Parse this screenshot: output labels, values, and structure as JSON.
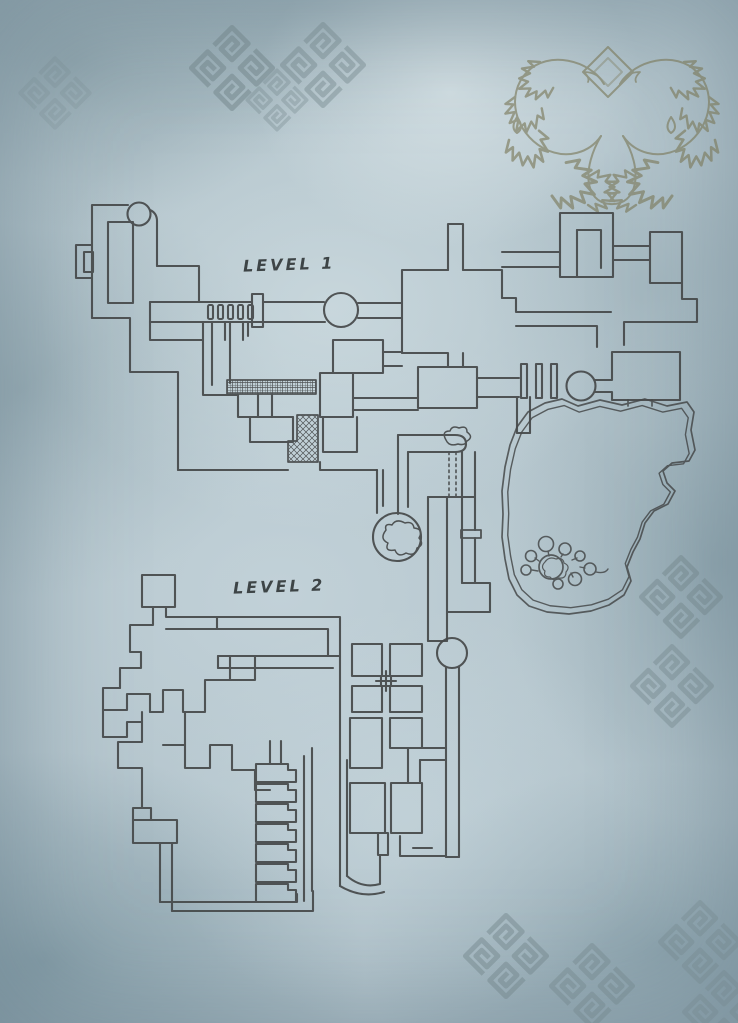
{
  "labels": {
    "level1": "LEVEL 1",
    "level2": "LEVEL 2"
  },
  "colors": {
    "background": "#b2c3ca",
    "line": "#46494a",
    "emblem": "#7d7c5e",
    "ornament": "#72858a",
    "label_text": "#3d4446"
  },
  "map": {
    "layers": [
      {
        "name": "ornament-knots",
        "stroke": "#72858a",
        "width": 6,
        "items": [
          {
            "u": "#knot",
            "tr": "translate(232,68) rotate(45) scale(0.82)",
            "o": 0.5
          },
          {
            "u": "#knot",
            "tr": "translate(323,65) rotate(45) scale(0.82)",
            "o": 0.42
          },
          {
            "u": "#knot",
            "tr": "translate(277,100) rotate(45) scale(0.6)",
            "o": 0.33
          },
          {
            "u": "#knot",
            "tr": "translate(55,93) rotate(45) scale(0.7)",
            "o": 0.2
          },
          {
            "u": "#knot",
            "tr": "translate(681,597) rotate(45) scale(0.8)",
            "o": 0.45
          },
          {
            "u": "#knot",
            "tr": "translate(672,686) rotate(45) scale(0.8)",
            "o": 0.4
          },
          {
            "u": "#knot",
            "tr": "translate(506,956) rotate(45) scale(0.82)",
            "o": 0.45
          },
          {
            "u": "#knot",
            "tr": "translate(592,986) rotate(45) scale(0.82)",
            "o": 0.4
          },
          {
            "u": "#knot",
            "tr": "translate(700,942) rotate(45) scale(0.8)",
            "o": 0.32
          },
          {
            "u": "#knot",
            "tr": "translate(724,1012) rotate(45) scale(0.8)",
            "o": 0.3
          }
        ]
      },
      {
        "name": "emblem-serpents",
        "stroke": "#7d7c5e",
        "width": 2,
        "opacity": 0.65,
        "items": [
          {
            "p": "M608,47 L633,72 L608,97 L583,72 Z"
          },
          {
            "p": "M608,58 L622,72 L608,86 L594,72 Z",
            "o": 0.6
          },
          {
            "p": "M604,84 C590,60 548,50 527,72 C505,95 515,132 543,148 C567,161 590,152 601,136"
          },
          {
            "p": "M620,84 C634,60 676,50 697,72 C719,95 709,132 681,148 C657,161 634,152 623,136"
          },
          {
            "p": "M601,136 C582,168 584,202 610,204 C638,206 644,170 623,136"
          },
          {
            "p": "M604,84 q-6,-12 -20,-12 q6,6 4,10",
            "w": 1.8
          },
          {
            "p": "M620,84 q6,-12 20,-12 q-6,6 -4,10",
            "w": 1.8
          },
          {
            "p": "M517,117 q-7,11 0,16 q8,-5 0,-16"
          },
          {
            "p": "M671,117 q-7,11 0,16 q8,-5 0,-16"
          },
          {
            "u": "#leafT",
            "tr": "translate(540,62) rotate(-20) scale(1.2)"
          },
          {
            "u": "#leafT",
            "tr": "translate(515,97) rotate(-60) scale(1.2)"
          },
          {
            "u": "#leafT",
            "tr": "translate(509,140) rotate(-100) scale(1.3)"
          },
          {
            "u": "#leafT",
            "tr": "translate(552,196) rotate(-150) scale(1.5)"
          },
          {
            "u": "#leafT",
            "tr": "translate(588,205) rotate(-170) scale(1.2)"
          },
          {
            "u": "#leafT",
            "tr": "translate(684,62) scale(-1.2,1.2) rotate(-20)"
          },
          {
            "u": "#leafT",
            "tr": "translate(709,97) scale(-1.2,1.2) rotate(-60)"
          },
          {
            "u": "#leafT",
            "tr": "translate(715,140) scale(-1.3,1.3) rotate(-100)"
          },
          {
            "u": "#leafT",
            "tr": "translate(672,196) scale(-1.5,1.5) rotate(-150)"
          },
          {
            "u": "#leafT",
            "tr": "translate(636,205) scale(-1.2,1.2) rotate(-170)"
          }
        ]
      },
      {
        "name": "level1-floorplan",
        "stroke": "#46494a",
        "width": 2.1,
        "opacity": 0.92,
        "items": [
          {
            "p": "M92,318 V205 H128"
          },
          {
            "c": [
              139,
              214,
              11.5
            ]
          },
          {
            "p": "M150,210 Q157,213 157,221 V266"
          },
          {
            "p": "M108,222 H133 V303 H108 Z"
          },
          {
            "p": "M92,245 H76 V278 H92"
          },
          {
            "r": [
              84,
              252,
              9,
              20
            ]
          },
          {
            "p": "M157,266 H199 V302"
          },
          {
            "p": "M92,318 H130 V372 H178 V470"
          },
          {
            "p": "M150,302 V322"
          },
          {
            "p": "M150,302 H252"
          },
          {
            "p": "M263,302 H324"
          },
          {
            "p": "M150,322 H325"
          },
          {
            "r": [
              208,
              305,
              5,
              14,
              1.5
            ]
          },
          {
            "r": [
              218,
              305,
              5,
              14,
              1.5
            ]
          },
          {
            "r": [
              228,
              305,
              5,
              14,
              1.5
            ]
          },
          {
            "r": [
              238,
              305,
              5,
              14,
              1.5
            ]
          },
          {
            "r": [
              248,
              305,
              5,
              14,
              1.5
            ]
          },
          {
            "r": [
              252,
              294,
              11,
              33
            ]
          },
          {
            "c": [
              341,
              310,
              17
            ]
          },
          {
            "p": "M358,303 H402"
          },
          {
            "p": "M358,318 H402"
          },
          {
            "p": "M402,353 V270 H448"
          },
          {
            "p": "M448,270 V224 H463 V270"
          },
          {
            "p": "M463,270 H502 V298"
          },
          {
            "p": "M402,353 H448 V367"
          },
          {
            "p": "M463,353 V367"
          },
          {
            "p": "M418,367 H477 V408 H418 Z"
          },
          {
            "p": "M477,378 H519"
          },
          {
            "p": "M477,397 H519"
          },
          {
            "r": [
              521,
              364,
              6,
              34
            ]
          },
          {
            "r": [
              536,
              364,
              6,
              34
            ]
          },
          {
            "r": [
              551,
              364,
              6,
              34
            ]
          },
          {
            "c": [
              581,
              386,
              14.5
            ]
          },
          {
            "p": "M517,397 V433"
          },
          {
            "p": "M530,397 V433"
          },
          {
            "p": "M517,433 H530"
          },
          {
            "p": "M595,380 H612 V352 H680 V400 H612 V392 H595"
          },
          {
            "p": "M560,277 V213 H613 V277 H560"
          },
          {
            "p": "M577,230 V277"
          },
          {
            "p": "M577,230 H601 V268"
          },
          {
            "p": "M560,252 H502"
          },
          {
            "p": "M560,267 H502"
          },
          {
            "p": "M613,246 H650"
          },
          {
            "p": "M613,260 H650"
          },
          {
            "p": "M650,283 V232 H682 V283 H650"
          },
          {
            "p": "M682,283 V299 H697 V322 H624 V345"
          },
          {
            "p": "M502,298 H516 V312 H611"
          },
          {
            "p": "M516,326 H597 V347"
          },
          {
            "p": "M150,322 V340 H203"
          },
          {
            "p": "M203,322 V395 H238 V417 H293"
          },
          {
            "p": "M212,322 V385"
          },
          {
            "p": "M225,322 V340"
          },
          {
            "p": "M230,322 V383"
          },
          {
            "p": "M243,322 V340"
          },
          {
            "p": "M248,322 V336"
          },
          {
            "p": "M250,417 V442 H293 V417"
          },
          {
            "p": "M178,470 H288"
          },
          {
            "p": "M258,394 V417"
          },
          {
            "p": "M272,394 V417"
          },
          {
            "r": [
              227,
              380,
              89,
              14
            ],
            "f": "url(#pgrid)",
            "w": 1.7
          },
          {
            "p": "M297,415 H318 V462 H288 V441 H297 Z",
            "f": "url(#phatch)",
            "w": 1.7
          },
          {
            "p": "M320,373 H353 V417 H320 Z"
          },
          {
            "p": "M333,340 H383 V373 H333 Z"
          },
          {
            "p": "M323,417 V452 H357 V417"
          },
          {
            "p": "M320,462 V470 H377"
          },
          {
            "p": "M383,352 H402"
          },
          {
            "p": "M383,366 H402"
          },
          {
            "p": "M353,398 H418"
          },
          {
            "p": "M353,410 H418"
          }
        ]
      },
      {
        "name": "level1-central-passages",
        "stroke": "#46494a",
        "width": 2.1,
        "opacity": 0.92,
        "items": [
          {
            "p": "M377,470 V513"
          },
          {
            "p": "M383,470 V506"
          },
          {
            "p": "M398,435 H455 Q466,435 466,444 Q466,452 455,452 H408"
          },
          {
            "p": "M398,435 V514"
          },
          {
            "p": "M408,452 V507"
          },
          {
            "p": "M446,440 q-5,-9 4,-9 q2,-6 9,-3 q8,-3 8,4 q7,5 0,9 q-2,5 -9,3 q-9,3 -12,-4 z",
            "w": 1.5
          },
          {
            "p": "M449,452 V497",
            "dash": "2.5 3.5",
            "w": 1.6
          },
          {
            "p": "M456,452 V497",
            "dash": "2.5 3.5",
            "w": 1.6
          },
          {
            "c": [
              397,
              537,
              24
            ]
          },
          {
            "p": "M386,530 q-7,9 2,13 q-4,9 7,7 q3,8 11,3 q9,4 11,-5 q8,-3 2,-10 q5,-9 -5,-10 q-1,-7 -9,-5 q-9,-5 -13,2 q-8,-2 -6,5 z",
            "w": 1.5
          },
          {
            "p": "M428,497 H475"
          },
          {
            "p": "M428,497 V641"
          },
          {
            "p": "M447,497 V641"
          },
          {
            "p": "M462,452 V583"
          },
          {
            "p": "M475,452 V530"
          },
          {
            "p": "M475,538 V583"
          },
          {
            "r": [
              461,
              530,
              20,
              8
            ],
            "w": 1.8
          },
          {
            "p": "M462,583 H490 V612 H447"
          },
          {
            "p": "M428,641 H447"
          }
        ]
      },
      {
        "name": "level1-cave",
        "stroke": "#46494a",
        "width": 1.7,
        "opacity": 0.85,
        "items": [
          {
            "p": "M545,403 L562,399 L578,406 L600,400 L622,405 L645,399 L667,406 L687,402 L694,412 L691,430 L695,450 L689,461 L672,463 L663,471 L667,483 L675,491 L668,504 L654,511 L645,523 L640,539 L633,552 L627,567 L631,581 L624,595 L609,605 L591,611 L569,614 L547,612 L529,606 L517,595 L509,579 L505,559 L502,537 L503,514 L502,491 L505,467 L510,445 L517,427 L528,412 Z"
          },
          {
            "p": "M545,403 L562,399 L578,406 L600,400 L622,405 L645,399 L667,406 L687,402 L694,412 L691,430 L695,450 L689,461 L672,463 L663,471 L667,483 L675,491 L668,504 L654,511 L645,523 L640,539 L633,552 L627,567 L631,581 L624,595 L609,605 L591,611 L569,614 L547,612 L529,606 L517,595 L509,579 L505,559 L502,537 L503,514 L502,491 L505,467 L510,445 L517,427 L528,412 Z",
            "tr": "translate(35.88,30.48) scale(0.94)",
            "w": 1.5
          },
          {
            "p": "M628,400 V406"
          },
          {
            "p": "M652,400 V406"
          },
          {
            "c": [
              551,
              567,
              12
            ],
            "w": 1.7
          },
          {
            "p": "M545,562 q-5,5 0,9 q-2,6 5,6 q4,5 9,1 q7,1 7,-6 q5,-6 -2,-9 q-1,-6 -8,-4 q-7,-3 -11,3 z",
            "w": 1.2
          },
          {
            "c": [
              546,
              544,
              7.5
            ],
            "w": 1.6
          },
          {
            "c": [
              531,
              556,
              5.5
            ],
            "w": 1.6
          },
          {
            "c": [
              526,
              570,
              5
            ],
            "w": 1.6
          },
          {
            "c": [
              565,
              549,
              6
            ],
            "w": 1.6
          },
          {
            "c": [
              580,
              556,
              5
            ],
            "w": 1.6
          },
          {
            "c": [
              590,
              569,
              6
            ],
            "w": 1.6
          },
          {
            "c": [
              575,
              579,
              6.5
            ],
            "w": 1.6
          },
          {
            "c": [
              558,
              584,
              5
            ],
            "w": 1.6
          },
          {
            "p": "M549,556 L548,551",
            "w": 1.4
          },
          {
            "p": "M539,561 L535,558",
            "w": 1.4
          },
          {
            "p": "M538,571 L532,570",
            "w": 1.4
          },
          {
            "p": "M561,557 L563,554",
            "w": 1.4
          },
          {
            "p": "M572,560 L577,558",
            "w": 1.4
          },
          {
            "p": "M580,567 L585,568",
            "w": 1.4
          },
          {
            "p": "M571,573 L573,577",
            "w": 1.4
          },
          {
            "p": "M596,572 q9,2 12,-3",
            "w": 1.4
          }
        ]
      },
      {
        "name": "level2-floorplan",
        "stroke": "#46494a",
        "width": 2.1,
        "opacity": 0.92,
        "items": [
          {
            "p": "M142,575 H175 V607 H142 Z"
          },
          {
            "p": "M153,607 V625 H130 V652 H141 V668 H120 V688"
          },
          {
            "p": "M166,607 V617 H217"
          },
          {
            "p": "M166,629 H217"
          },
          {
            "p": "M217,617 V629"
          },
          {
            "p": "M217,617 H340 V641"
          },
          {
            "p": "M217,629 H328 V641"
          },
          {
            "p": "M218,656 H340"
          },
          {
            "p": "M218,668 H333"
          },
          {
            "p": "M218,656 V668"
          },
          {
            "p": "M328,641 V656"
          },
          {
            "p": "M340,641 V886"
          },
          {
            "p": "M120,688 H103 V710 H127 V694 H150 V712"
          },
          {
            "p": "M103,710 V737 H127 V722 H142 V712"
          },
          {
            "p": "M142,722 V742 H118 V768 H142 V808"
          },
          {
            "p": "M150,712 H163 V690 H183 V712 H205 V680 H230 V656"
          },
          {
            "p": "M230,680 H255 V656"
          },
          {
            "p": "M185,712 V745"
          },
          {
            "p": "M163,745 H185 V768 H210 V745 H232 V770 H255 V790 H270"
          },
          {
            "p": "M133,820 H177 V843 H133 Z"
          },
          {
            "p": "M133,820 V808 H151 V820"
          },
          {
            "p": "M160,843 V902"
          },
          {
            "p": "M172,843 V911"
          },
          {
            "p": "M160,902 H297 V894"
          },
          {
            "p": "M172,911 H313 V891"
          },
          {
            "p": "M256,764 H288 V770 H296 V782 H256 Z"
          },
          {
            "p": "M256,784 H288 V790 H296 V802 H256 Z"
          },
          {
            "p": "M256,804 H288 V810 H296 V822 H256 Z"
          },
          {
            "p": "M256,824 H288 V830 H296 V842 H256 Z"
          },
          {
            "p": "M256,844 H288 V850 H296 V862 H256 Z"
          },
          {
            "p": "M256,864 H288 V870 H296 V882 H256 Z"
          },
          {
            "p": "M256,884 H288 V890 H296 V902 H256 Z"
          },
          {
            "p": "M270,764 V741"
          },
          {
            "p": "M281,764 V741"
          },
          {
            "p": "M304,756 V901"
          },
          {
            "p": "M312,748 V891"
          },
          {
            "r": [
              352,
              644,
              30,
              32
            ]
          },
          {
            "r": [
              390,
              644,
              32,
              32
            ]
          },
          {
            "r": [
              352,
              686,
              30,
              26
            ]
          },
          {
            "r": [
              390,
              686,
              32,
              26
            ]
          },
          {
            "r": [
              350,
              718,
              32,
              50
            ]
          },
          {
            "r": [
              390,
              718,
              32,
              30
            ]
          },
          {
            "p": "M376,681 H396"
          },
          {
            "p": "M386,671 V691"
          },
          {
            "r": [
              381,
              676,
              10,
              10
            ]
          },
          {
            "c": [
              452,
              653,
              15
            ]
          },
          {
            "p": "M446,667 V857"
          },
          {
            "p": "M459,667 V857"
          },
          {
            "p": "M446,857 H459"
          },
          {
            "p": "M408,748 H446"
          },
          {
            "p": "M420,760 H446"
          },
          {
            "p": "M408,748 V783"
          },
          {
            "p": "M420,760 V783"
          },
          {
            "p": "M347,760 V876"
          },
          {
            "r": [
              350,
              783,
              35,
              50
            ]
          },
          {
            "r": [
              391,
              783,
              31,
              50
            ]
          },
          {
            "r": [
              378,
              833,
              10,
              22
            ]
          },
          {
            "p": "M347,876 Q362,889 380,884 V856"
          },
          {
            "p": "M340,886 Q362,899 384,892"
          },
          {
            "p": "M400,836 V856 H445"
          },
          {
            "p": "M413,848 H432"
          }
        ]
      }
    ]
  }
}
